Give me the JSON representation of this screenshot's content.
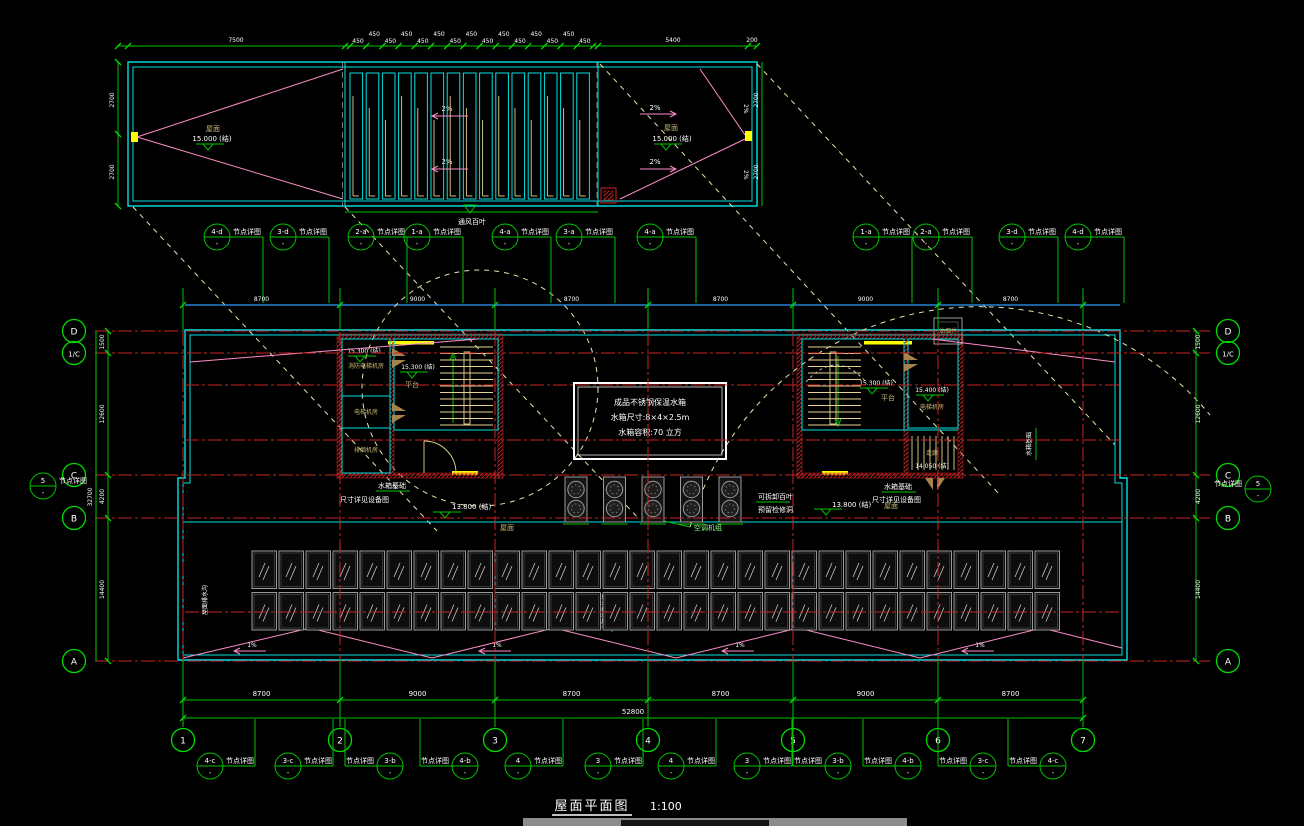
{
  "title": {
    "name": "屋面平面图",
    "scale": "1:100"
  },
  "palette": {
    "cyan": "#00E2E2",
    "green": "#00C400",
    "red": "#C82323",
    "pink": "#FF8CC8",
    "yellow": "#FFFF00",
    "tan": "#E3D28F",
    "dash_yellow": "#E6E6AA",
    "blue": "#2E9BFF",
    "white": "#FFFFFF",
    "label_yellow": "#C9B872",
    "gray": "#9A9A9A"
  },
  "note_label": "节点详图",
  "callout_dash": "-",
  "grids": {
    "cols": [
      {
        "label": "1",
        "x": 183
      },
      {
        "label": "2",
        "x": 340
      },
      {
        "label": "3",
        "x": 495
      },
      {
        "label": "4",
        "x": 648
      },
      {
        "label": "5",
        "x": 793
      },
      {
        "label": "6",
        "x": 938
      },
      {
        "label": "7",
        "x": 1083
      }
    ],
    "rows": [
      {
        "label": "D",
        "y": 331
      },
      {
        "label": "1/C",
        "y": 353
      },
      {
        "label": "C",
        "y": 475
      },
      {
        "label": "B",
        "y": 518
      },
      {
        "label": "A",
        "y": 661
      }
    ],
    "aux_row_ys": [
      385,
      440
    ]
  },
  "callouts": {
    "top": {
      "y": 237,
      "items": [
        {
          "label": "4-d",
          "x": 217
        },
        {
          "label": "3-d",
          "x": 283
        },
        {
          "label": "2-a",
          "x": 361
        },
        {
          "label": "1-a",
          "x": 417
        },
        {
          "label": "4-a",
          "x": 505
        },
        {
          "label": "3-a",
          "x": 569
        },
        {
          "label": "4-a",
          "x": 650
        },
        {
          "label": "1-a",
          "x": 866
        },
        {
          "label": "2-a",
          "x": 926
        },
        {
          "label": "3-d",
          "x": 1012
        },
        {
          "label": "4-d",
          "x": 1078
        }
      ]
    },
    "bottom": {
      "y": 766,
      "items": [
        {
          "label": "4-c",
          "x": 210,
          "side": "r"
        },
        {
          "label": "3-c",
          "x": 288,
          "side": "r"
        },
        {
          "label": "3-b",
          "x": 390,
          "side": "l"
        },
        {
          "label": "4-b",
          "x": 465,
          "side": "l"
        },
        {
          "label": "4",
          "x": 518,
          "side": "r"
        },
        {
          "label": "3",
          "x": 598,
          "side": "r"
        },
        {
          "label": "4",
          "x": 671,
          "side": "r"
        },
        {
          "label": "3",
          "x": 747,
          "side": "r"
        },
        {
          "label": "3-b",
          "x": 838,
          "side": "l"
        },
        {
          "label": "4-b",
          "x": 908,
          "side": "l"
        },
        {
          "label": "3-c",
          "x": 983,
          "side": "l"
        },
        {
          "label": "4-c",
          "x": 1053,
          "side": "l"
        }
      ]
    },
    "side": [
      {
        "label": "5",
        "x": 43,
        "y": 486,
        "side": "r"
      },
      {
        "label": "5",
        "x": 1258,
        "y": 489,
        "side": "l"
      }
    ]
  },
  "upper_block": {
    "slope": "2%",
    "roof": "屋面",
    "elev": "15.000 (结)",
    "vent": "通风百叶",
    "louver_count": 15,
    "dims_top": {
      "left": "7500",
      "cell": "450",
      "right": "5400",
      "end": "200"
    },
    "dims_side": [
      "2700",
      "2700"
    ]
  },
  "plan": {
    "tank": {
      "l1": "成品不锈钢保温水箱",
      "l2": "水箱尺寸:8×4×2.5m",
      "l3": "水箱容积:70 立方"
    },
    "rooms": {
      "fire_elev": "消防电梯机房",
      "elev_room": "电梯机房",
      "smoke": "排烟机房",
      "corridor": "走廊",
      "flue": "油烟井",
      "platform": "平台"
    },
    "elevs": {
      "core": "15.300 (结)",
      "elev_machine": "15.400 (结)",
      "low": "14.050 (结)",
      "roof": "13.800 (结)"
    },
    "notes": {
      "tank_base": "水箱基础",
      "tank_dim": "尺寸详见设备图",
      "louver_a": "可拆卸百叶",
      "louver_b": "预留检修洞",
      "ac": "空调机组",
      "solar": "太阳能集热板",
      "drain": "屋面排水沟"
    },
    "slope": "1%",
    "equip": {
      "ac_count": 5,
      "solar_per_row": 30
    },
    "dims": {
      "bays": [
        "8700",
        "9000",
        "8700",
        "8700",
        "9000",
        "8700"
      ],
      "total": "52800",
      "left_segs": [
        "1500",
        "12600",
        "4200",
        "14400"
      ],
      "left_total": "32700"
    }
  }
}
